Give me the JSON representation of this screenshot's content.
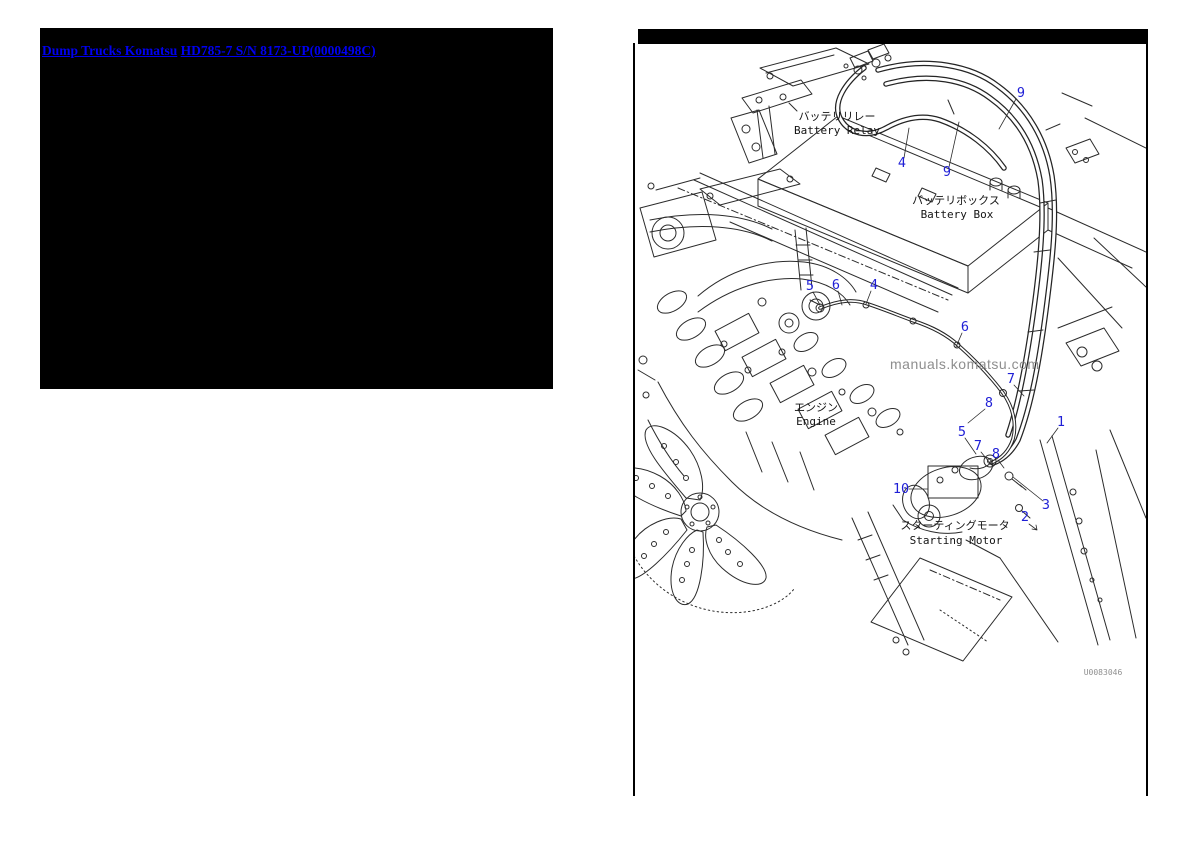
{
  "breadcrumb": {
    "panel_background": "#000000",
    "link_color": "#0000f0",
    "links": [
      {
        "label": "Dump Trucks Komatsu"
      },
      {
        "label": "HD785-7 S/N 8173-UP(0000498C)"
      }
    ]
  },
  "diagram": {
    "frame_color": "#000000",
    "line_color": "#2b2b2b",
    "callout_color": "#1f1fd6",
    "watermark": {
      "text": "manuals.komatsu.com",
      "color": "#8e8e8e"
    },
    "drawing_number": {
      "text": "U0083046",
      "color": "#8f8f8f"
    },
    "labels": [
      {
        "jp": "バッテリリレー",
        "en": "Battery Relay"
      },
      {
        "jp": "バッテリボックス",
        "en": "Battery Box"
      },
      {
        "jp": "エンジン",
        "en": "Engine"
      },
      {
        "jp": "スターティングモータ",
        "en": "Starting Motor"
      }
    ],
    "callouts": [
      {
        "label": "9"
      },
      {
        "label": "4"
      },
      {
        "label": "9"
      },
      {
        "label": "5"
      },
      {
        "label": "6"
      },
      {
        "label": "4"
      },
      {
        "label": "6"
      },
      {
        "label": "7"
      },
      {
        "label": "8"
      },
      {
        "label": "1"
      },
      {
        "label": "5"
      },
      {
        "label": "7"
      },
      {
        "label": "8"
      },
      {
        "label": "10"
      },
      {
        "label": "3"
      },
      {
        "label": "2"
      }
    ]
  }
}
